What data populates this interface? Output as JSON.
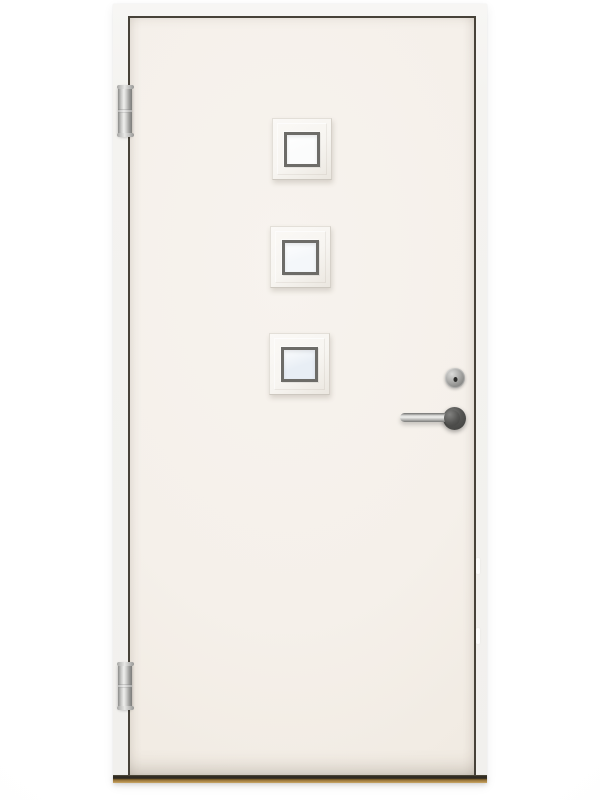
{
  "scene": {
    "type": "product-photo",
    "description": "White exterior front door with three square windows, left-side hinges, stainless lever handle, lock cylinder and wooden threshold",
    "background_color": "#ffffff"
  },
  "door": {
    "window_count": 3,
    "hinge_count": 2,
    "colors": {
      "frame": "#f4f3f0",
      "leaf": "#f5f0ea",
      "leaf_shade": "#eee7dd",
      "gap": "#474239",
      "moulding": "#f7f5f1",
      "moulding_shadow": "#cdc8c0",
      "glazing_frame": "#6d6c68",
      "chrome_light": "#efefed",
      "chrome_dark": "#8b8b89",
      "rosette": "#555553",
      "cylinder": "#b3b3b1",
      "cylinder_core": "#6f6f6d",
      "threshold_dark": "#2f2a22",
      "threshold_wood": "#96743a",
      "threshold_wood_light": "#caa869"
    },
    "windows": [
      {
        "id": "top",
        "glass_color": "#fbfcfc"
      },
      {
        "id": "middle",
        "glass_color": "#f4f7fa"
      },
      {
        "id": "bottom",
        "glass_color": "#e8eef5"
      }
    ]
  }
}
